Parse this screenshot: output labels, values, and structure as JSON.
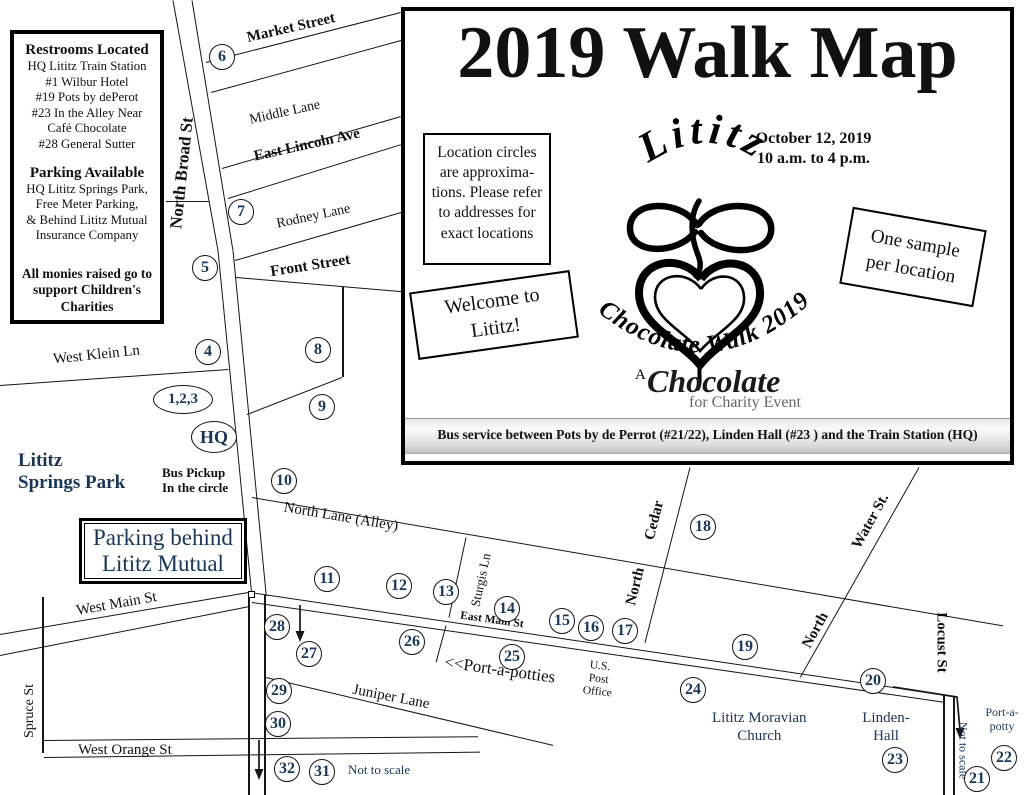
{
  "colors": {
    "accent_navy": "#17365D",
    "line_black": "#151515"
  },
  "info_box": {
    "restrooms_title": "Restrooms Located",
    "restrooms_lines": "HQ Lititz Train Station\n#1 Wilbur Hotel\n#19 Pots by dePerot\n#23 In the Alley Near\nCafé Chocolate\n#28 General Sutter",
    "parking_title": "Parking Available",
    "parking_lines": "HQ Lititz Springs Park,\nFree Meter Parking,\n& Behind Lititz Mutual\nInsurance Company",
    "charity_note": "All monies raised go to\nsupport Children's\nCharities"
  },
  "panel": {
    "title": "2019 Walk Map",
    "location_note": "Location circles\nare approxima-\ntions. Please refer\nto addresses for\nexact locations",
    "date_time": "October 12, 2019\n10 a.m. to 4 p.m.",
    "welcome": "Welcome to\nLititz!",
    "one_sample": "One sample\nper location",
    "logo": {
      "city": "Lititz",
      "event_arc": "Chocolate Walk 2019",
      "prefix": "A",
      "brand": "Chocolate",
      "tagline": "for Charity Event"
    },
    "bus_note": "Bus service between Pots by de Perrot (#21/22), Linden Hall (#23 ) and the Train Station (HQ)"
  },
  "streets": {
    "market": "Market Street",
    "middle": "Middle Lane",
    "lincoln": "East Lincoln Ave",
    "rodney": "Rodney Lane",
    "front": "Front Street",
    "north_broad": "North Broad St",
    "west_klein": "West Klein Ln",
    "north_lane": "North Lane (Alley)",
    "west_main": "West Main St",
    "east_main": "East Main St",
    "sturgis": "Sturgis Ln",
    "juniper": "Juniper Lane",
    "west_orange": "West Orange St",
    "spruce": "Spruce St",
    "cedar_prefix": "North",
    "cedar_name": "Cedar",
    "water_prefix": "North",
    "water_name": "Water St.",
    "locust": "Locust St"
  },
  "places": {
    "springs_park": "Lititz\nSprings Park",
    "bus_pickup": "Bus Pickup\nIn the circle",
    "parking_behind": "Parking behind\nLititz Mutual",
    "port_a_potties": "<<Port-a-potties",
    "post_office": "U.S.\nPost\nOffice",
    "moravian_church": "Lititz Moravian\nChurch",
    "linden_hall": "Linden-\nHall",
    "port_a_potty": "Port-a-\npotty",
    "not_to_scale_bottom": "Not to scale",
    "not_to_scale_right": "Not to scale"
  },
  "circles": {
    "c1_3": "1,2,3",
    "hq": "HQ",
    "c4": "4",
    "c5": "5",
    "c6": "6",
    "c7": "7",
    "c8": "8",
    "c9": "9",
    "c10": "10",
    "c11": "11",
    "c12": "12",
    "c13": "13",
    "c14": "14",
    "c15": "15",
    "c16": "16",
    "c17": "17",
    "c18": "18",
    "c19": "19",
    "c20": "20",
    "c21": "21",
    "c22": "22",
    "c23": "23",
    "c24": "24",
    "c25": "25",
    "c26": "26",
    "c27": "27",
    "c28": "28",
    "c29": "29",
    "c30": "30",
    "c31": "31",
    "c32": "32"
  }
}
